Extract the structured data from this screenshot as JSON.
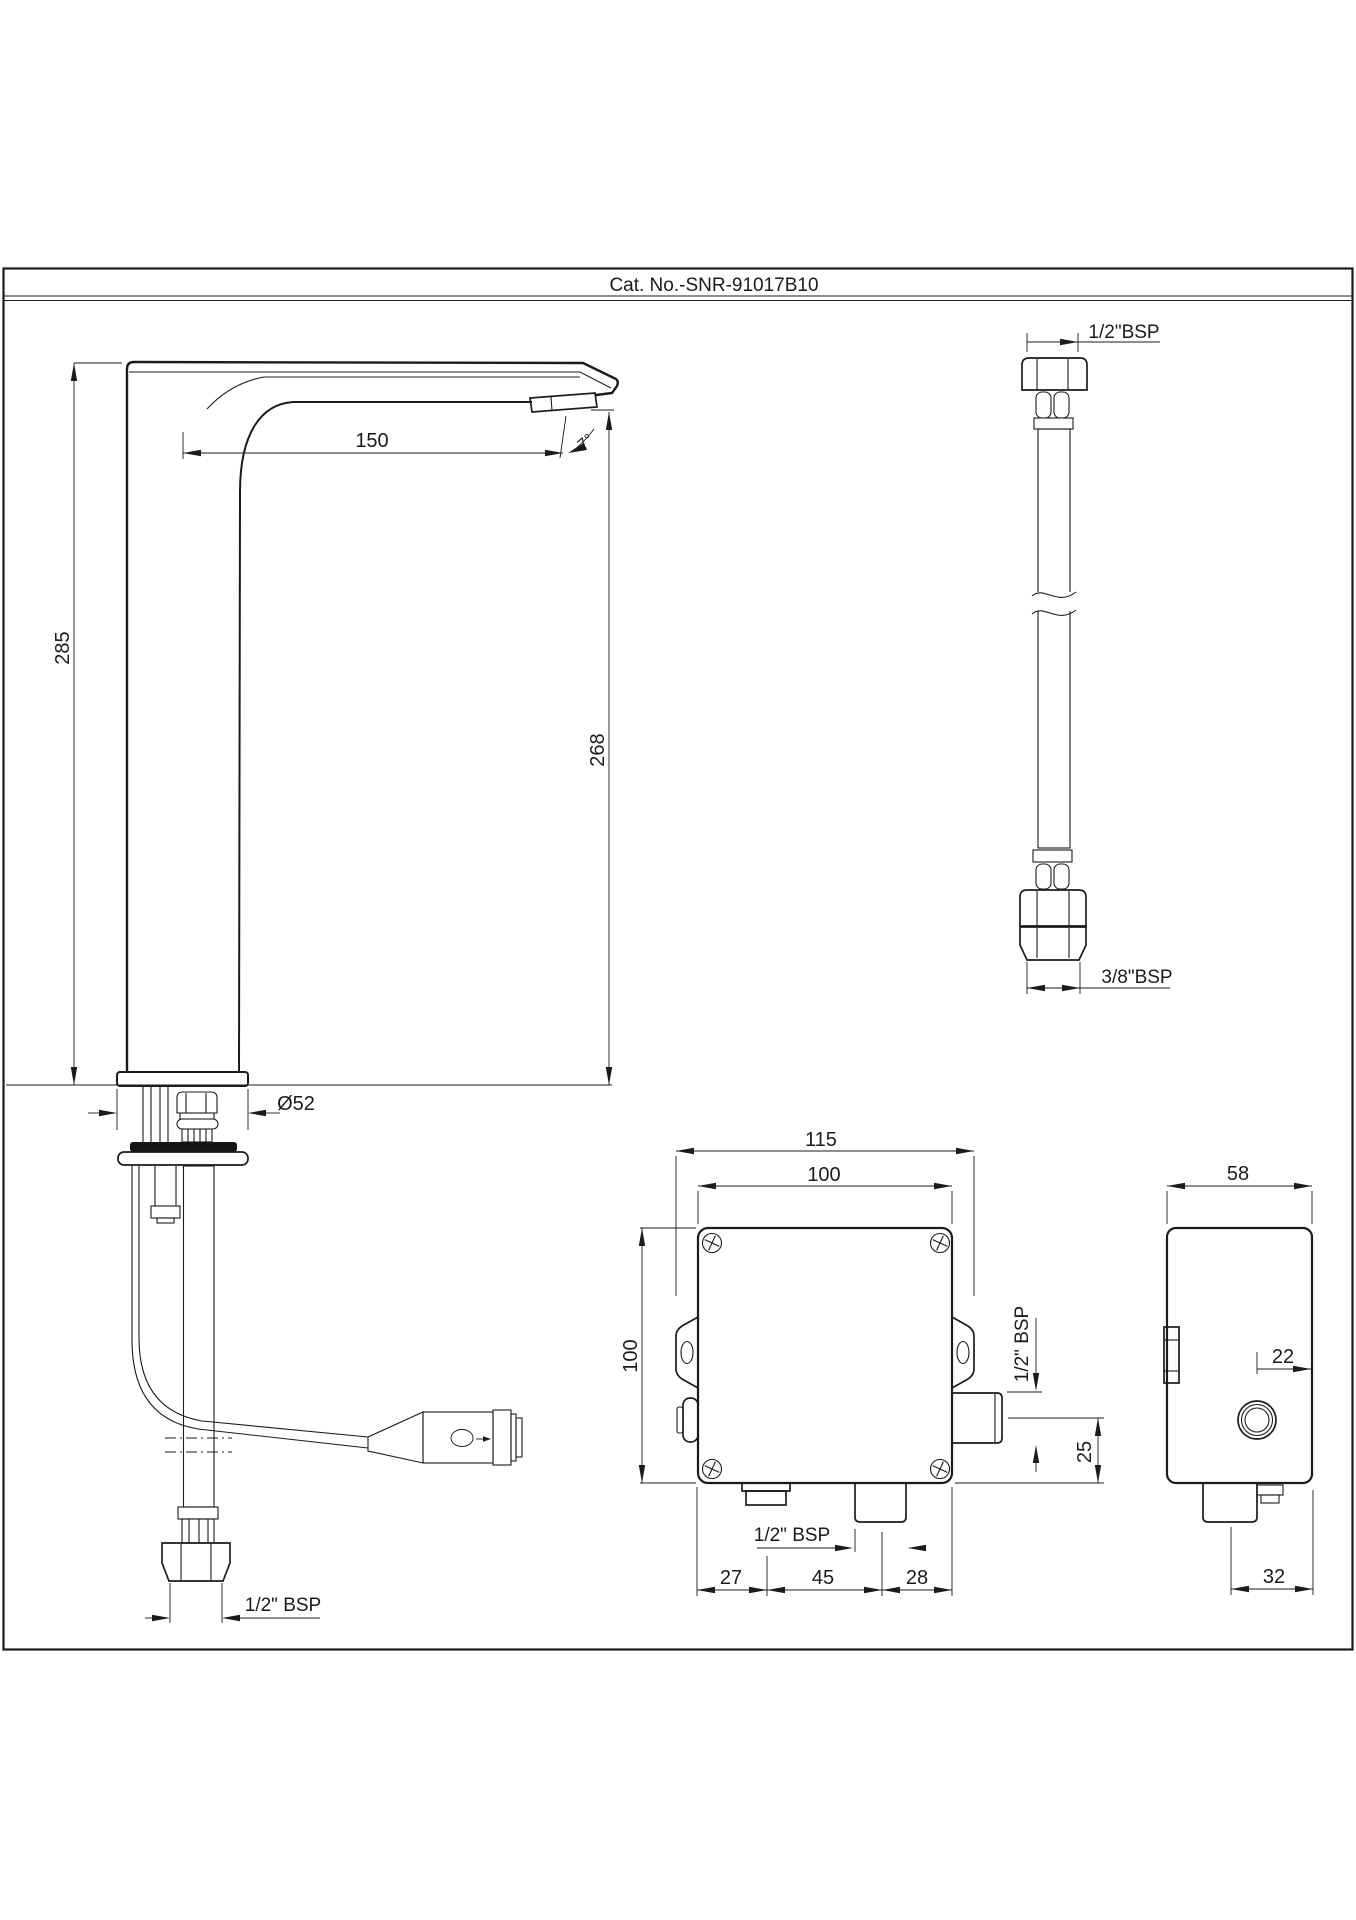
{
  "title": "Cat. No.-SNR-91017B10",
  "views": {
    "faucet": {
      "name": "sensor faucet side elevation",
      "overall_height": "285",
      "spout_height": "268",
      "spout_reach": "150",
      "spout_angle": "7°",
      "base_diameter": "Ø52",
      "inlet_thread": "1/2\" BSP"
    },
    "hose": {
      "name": "flexible connection hose",
      "top_thread": "1/2\"BSP",
      "bottom_thread": "3/8\"BSP"
    },
    "box_front": {
      "name": "control box front view",
      "overall_width": "115",
      "body_width": "100",
      "body_height": "100",
      "side_outlet_thread": "1/2\" BSP",
      "outlet_center_offset": "25",
      "bottom_port_thread": "1/2\" BSP",
      "pitch_left": "27",
      "pitch_center": "45",
      "pitch_right": "28"
    },
    "box_side": {
      "name": "control box side view",
      "depth": "58",
      "port_offset": "22",
      "bottom_port_offset": "32"
    }
  }
}
